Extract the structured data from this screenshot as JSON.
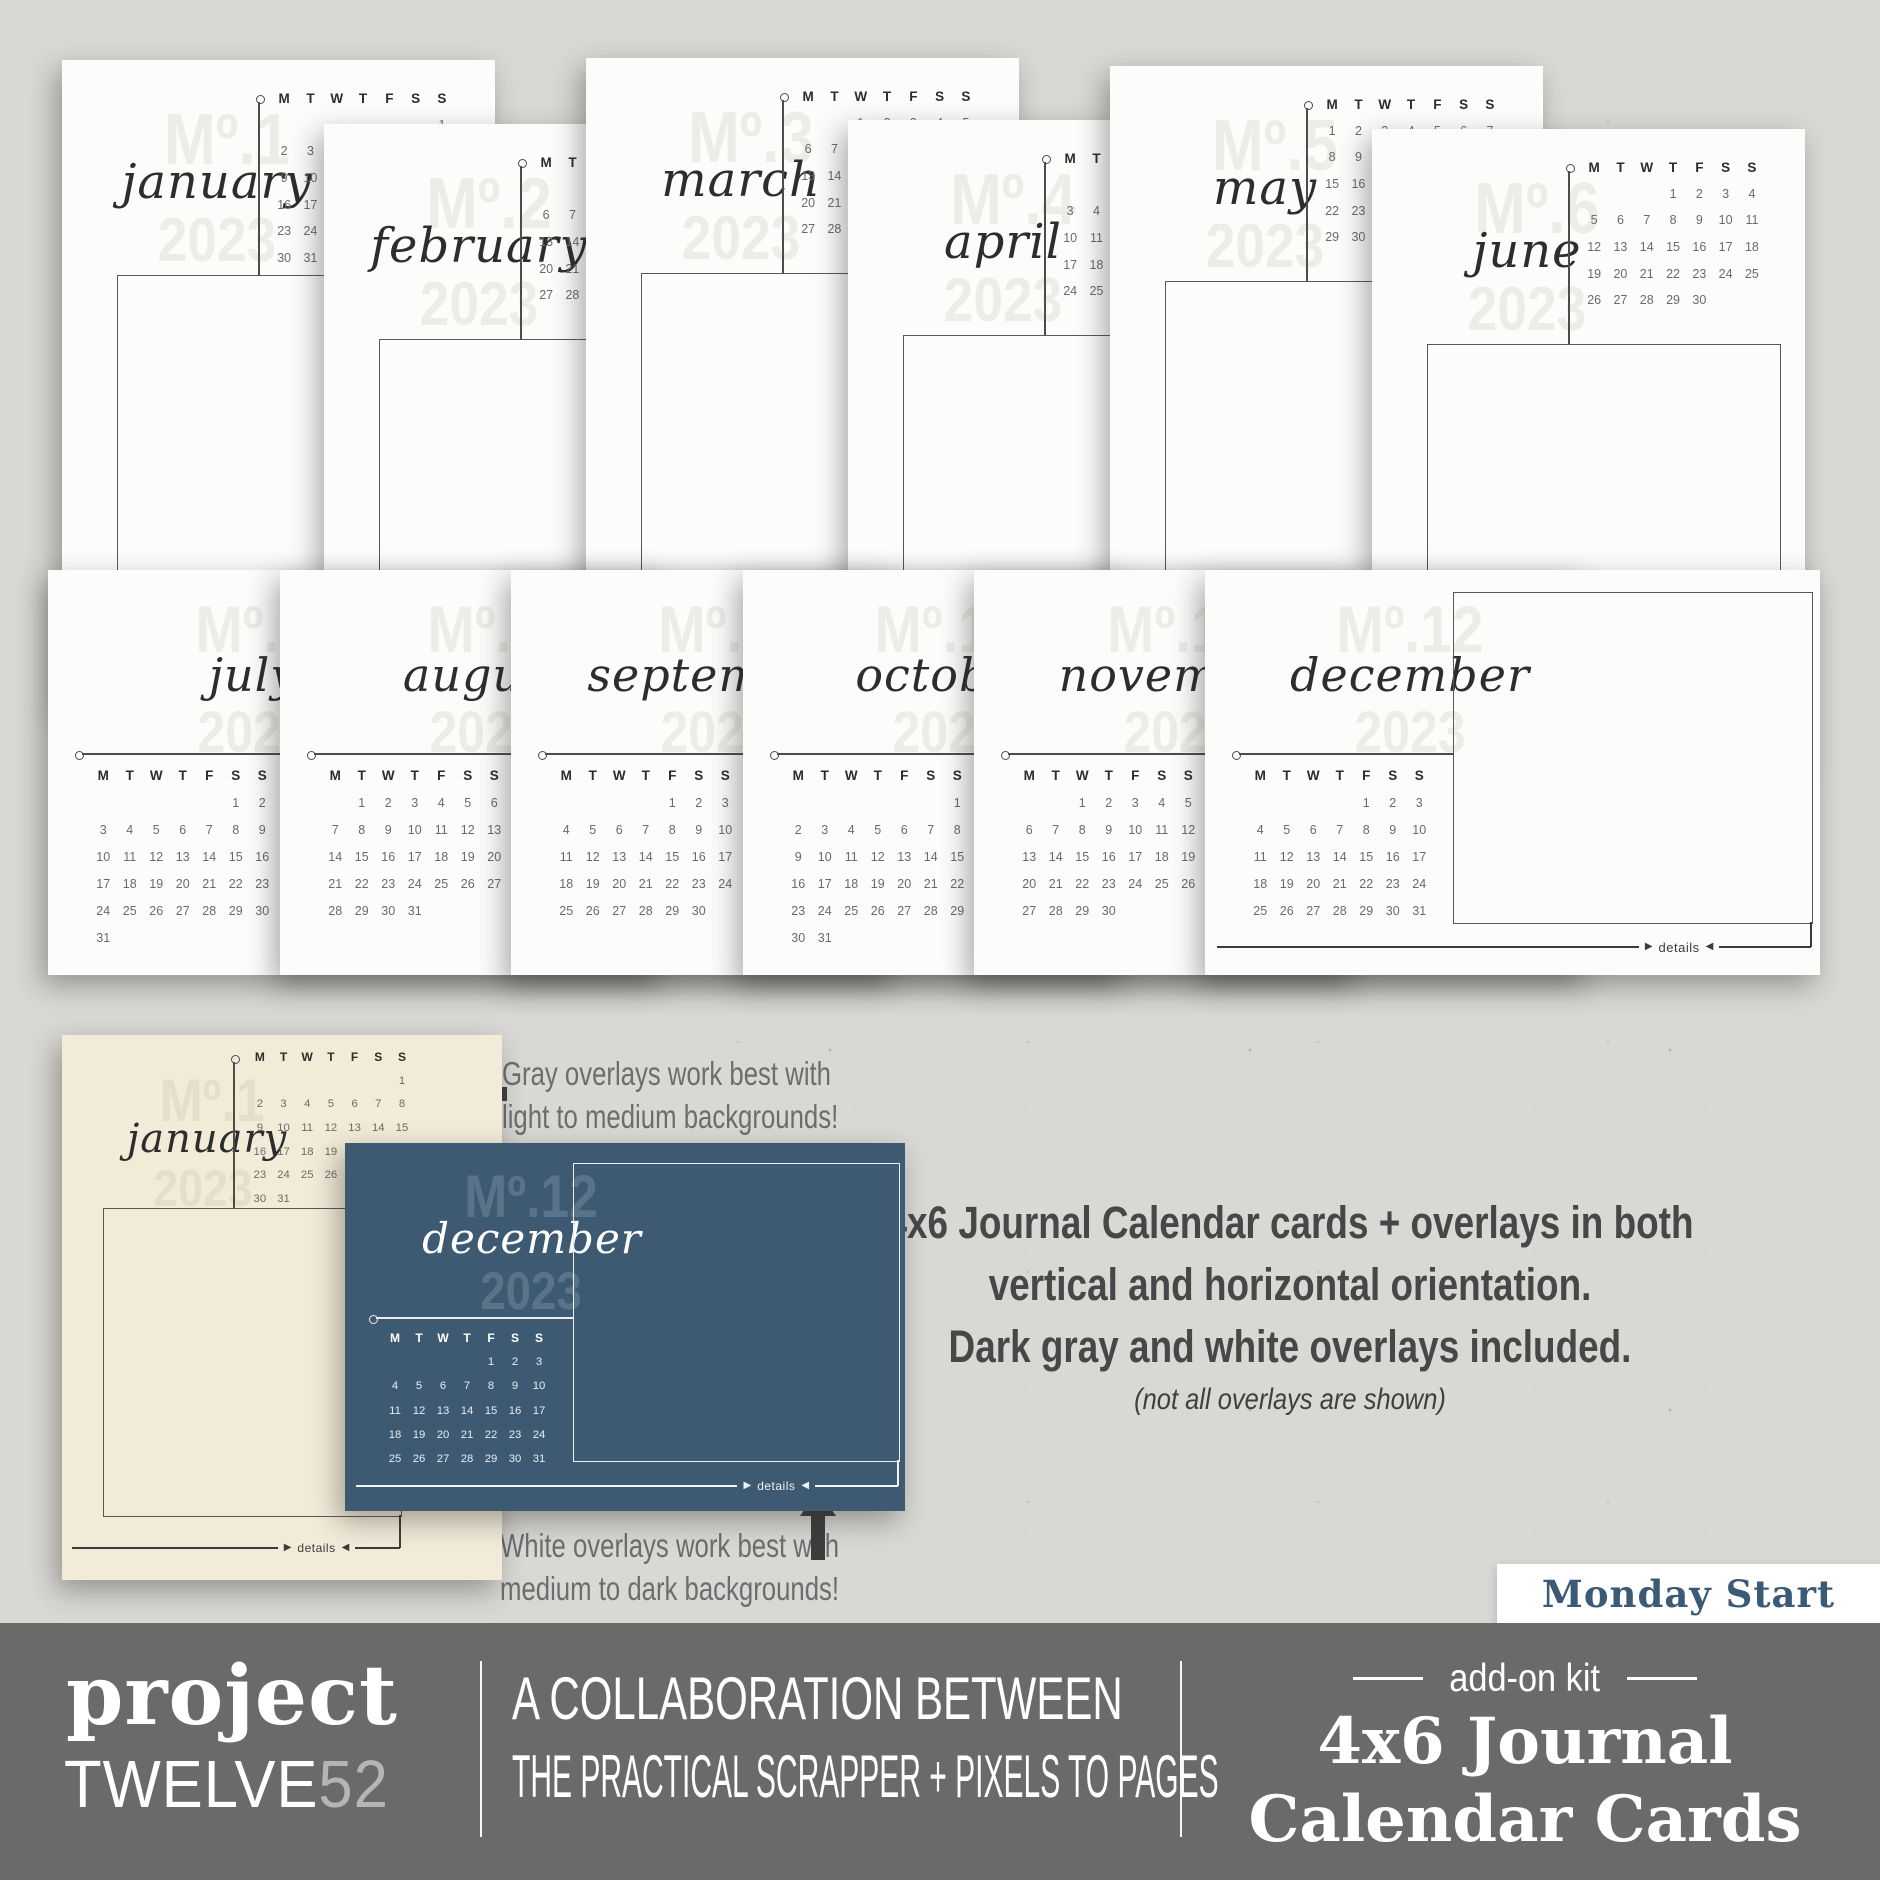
{
  "labels": {
    "details": "details"
  },
  "weekdays": [
    "M",
    "T",
    "W",
    "T",
    "F",
    "S",
    "S"
  ],
  "months": [
    {
      "wm": "Mº.1",
      "name": "january",
      "year": "2023",
      "rows": [
        [
          "",
          "",
          "",
          "",
          "",
          "",
          "1"
        ],
        [
          "2",
          "3",
          "4",
          "5",
          "6",
          "7",
          "8"
        ],
        [
          "9",
          "10",
          "11",
          "12",
          "13",
          "14",
          "15"
        ],
        [
          "16",
          "17",
          "18",
          "19",
          "20",
          "21",
          "22"
        ],
        [
          "23",
          "24",
          "25",
          "26",
          "27",
          "28",
          "29"
        ],
        [
          "30",
          "31",
          "",
          "",
          "",
          "",
          ""
        ]
      ]
    },
    {
      "wm": "Mº.2",
      "name": "february",
      "year": "2023",
      "rows": [
        [
          "",
          "",
          "1",
          "2",
          "3",
          "4",
          "5"
        ],
        [
          "6",
          "7",
          "8",
          "9",
          "10",
          "11",
          "12"
        ],
        [
          "13",
          "14",
          "15",
          "16",
          "17",
          "18",
          "19"
        ],
        [
          "20",
          "21",
          "22",
          "23",
          "24",
          "25",
          "26"
        ],
        [
          "27",
          "28",
          "",
          "",
          "",
          "",
          ""
        ]
      ]
    },
    {
      "wm": "Mº.3",
      "name": "march",
      "year": "2023",
      "rows": [
        [
          "",
          "",
          "1",
          "2",
          "3",
          "4",
          "5"
        ],
        [
          "6",
          "7",
          "8",
          "9",
          "10",
          "11",
          "12"
        ],
        [
          "13",
          "14",
          "15",
          "16",
          "17",
          "18",
          "19"
        ],
        [
          "20",
          "21",
          "22",
          "23",
          "24",
          "25",
          "26"
        ],
        [
          "27",
          "28",
          "29",
          "30",
          "31",
          "",
          ""
        ]
      ]
    },
    {
      "wm": "Mº.4",
      "name": "april",
      "year": "2023",
      "rows": [
        [
          "",
          "",
          "",
          "",
          "",
          "1",
          "2"
        ],
        [
          "3",
          "4",
          "5",
          "6",
          "7",
          "8",
          "9"
        ],
        [
          "10",
          "11",
          "12",
          "13",
          "14",
          "15",
          "16"
        ],
        [
          "17",
          "18",
          "19",
          "20",
          "21",
          "22",
          "23"
        ],
        [
          "24",
          "25",
          "26",
          "27",
          "28",
          "29",
          "30"
        ]
      ]
    },
    {
      "wm": "Mº.5",
      "name": "may",
      "year": "2023",
      "rows": [
        [
          "1",
          "2",
          "3",
          "4",
          "5",
          "6",
          "7"
        ],
        [
          "8",
          "9",
          "10",
          "11",
          "12",
          "13",
          "14"
        ],
        [
          "15",
          "16",
          "17",
          "18",
          "19",
          "20",
          "21"
        ],
        [
          "22",
          "23",
          "24",
          "25",
          "26",
          "27",
          "28"
        ],
        [
          "29",
          "30",
          "31",
          "",
          "",
          "",
          ""
        ]
      ]
    },
    {
      "wm": "Mº.6",
      "name": "june",
      "year": "2023",
      "rows": [
        [
          "",
          "",
          "",
          "1",
          "2",
          "3",
          "4"
        ],
        [
          "5",
          "6",
          "7",
          "8",
          "9",
          "10",
          "11"
        ],
        [
          "12",
          "13",
          "14",
          "15",
          "16",
          "17",
          "18"
        ],
        [
          "19",
          "20",
          "21",
          "22",
          "23",
          "24",
          "25"
        ],
        [
          "26",
          "27",
          "28",
          "29",
          "30",
          "",
          ""
        ]
      ]
    },
    {
      "wm": "Mº.7",
      "name": "july",
      "year": "2023",
      "rows": [
        [
          "",
          "",
          "",
          "",
          "",
          "1",
          "2"
        ],
        [
          "3",
          "4",
          "5",
          "6",
          "7",
          "8",
          "9"
        ],
        [
          "10",
          "11",
          "12",
          "13",
          "14",
          "15",
          "16"
        ],
        [
          "17",
          "18",
          "19",
          "20",
          "21",
          "22",
          "23"
        ],
        [
          "24",
          "25",
          "26",
          "27",
          "28",
          "29",
          "30"
        ],
        [
          "31",
          "",
          "",
          "",
          "",
          "",
          ""
        ]
      ]
    },
    {
      "wm": "Mº.8",
      "name": "august",
      "year": "2023",
      "rows": [
        [
          "",
          "1",
          "2",
          "3",
          "4",
          "5",
          "6"
        ],
        [
          "7",
          "8",
          "9",
          "10",
          "11",
          "12",
          "13"
        ],
        [
          "14",
          "15",
          "16",
          "17",
          "18",
          "19",
          "20"
        ],
        [
          "21",
          "22",
          "23",
          "24",
          "25",
          "26",
          "27"
        ],
        [
          "28",
          "29",
          "30",
          "31",
          "",
          "",
          ""
        ]
      ]
    },
    {
      "wm": "Mº.9",
      "name": "september",
      "year": "2023",
      "rows": [
        [
          "",
          "",
          "",
          "",
          "1",
          "2",
          "3"
        ],
        [
          "4",
          "5",
          "6",
          "7",
          "8",
          "9",
          "10"
        ],
        [
          "11",
          "12",
          "13",
          "14",
          "15",
          "16",
          "17"
        ],
        [
          "18",
          "19",
          "20",
          "21",
          "22",
          "23",
          "24"
        ],
        [
          "25",
          "26",
          "27",
          "28",
          "29",
          "30",
          ""
        ]
      ]
    },
    {
      "wm": "Mº.10",
      "name": "october",
      "year": "2023",
      "rows": [
        [
          "",
          "",
          "",
          "",
          "",
          "",
          "1"
        ],
        [
          "2",
          "3",
          "4",
          "5",
          "6",
          "7",
          "8"
        ],
        [
          "9",
          "10",
          "11",
          "12",
          "13",
          "14",
          "15"
        ],
        [
          "16",
          "17",
          "18",
          "19",
          "20",
          "21",
          "22"
        ],
        [
          "23",
          "24",
          "25",
          "26",
          "27",
          "28",
          "29"
        ],
        [
          "30",
          "31",
          "",
          "",
          "",
          "",
          ""
        ]
      ]
    },
    {
      "wm": "Mº.11",
      "name": "november",
      "year": "2023",
      "rows": [
        [
          "",
          "",
          "1",
          "2",
          "3",
          "4",
          "5"
        ],
        [
          "6",
          "7",
          "8",
          "9",
          "10",
          "11",
          "12"
        ],
        [
          "13",
          "14",
          "15",
          "16",
          "17",
          "18",
          "19"
        ],
        [
          "20",
          "21",
          "22",
          "23",
          "24",
          "25",
          "26"
        ],
        [
          "27",
          "28",
          "29",
          "30",
          "",
          "",
          ""
        ]
      ]
    },
    {
      "wm": "Mº.12",
      "name": "december",
      "year": "2023",
      "rows": [
        [
          "",
          "",
          "",
          "",
          "1",
          "2",
          "3"
        ],
        [
          "4",
          "5",
          "6",
          "7",
          "8",
          "9",
          "10"
        ],
        [
          "11",
          "12",
          "13",
          "14",
          "15",
          "16",
          "17"
        ],
        [
          "18",
          "19",
          "20",
          "21",
          "22",
          "23",
          "24"
        ],
        [
          "25",
          "26",
          "27",
          "28",
          "29",
          "30",
          "31"
        ]
      ]
    }
  ],
  "annotations": {
    "gray_line1": "Gray overlays work best with",
    "gray_line2": "light to medium backgrounds!",
    "white_line1": "White overlays work best with",
    "white_line2": "medium to dark backgrounds!"
  },
  "description": {
    "line1": "4x6 Journal Calendar cards + overlays in both",
    "line2": "vertical and horizontal orientation.",
    "line3": "Dark gray and white overlays included.",
    "note": "(not all overlays are shown)"
  },
  "badge": {
    "label": "Monday Start"
  },
  "footer": {
    "brand_top": "project",
    "brand_word": "TWELVE",
    "brand_num": "52",
    "collab_line1": "A COLLABORATION BETWEEN",
    "collab_line2": "THE PRACTICAL SCRAPPER + PIXELS TO PAGES",
    "kit_label": "add-on kit",
    "title_line1": "4x6 Journal",
    "title_line2": "Calendar Cards"
  },
  "colors": {
    "background": "#d9d8d4",
    "card_white": "#fcfcfb",
    "card_cream": "#f1ebd8",
    "card_blue": "#3e5a73",
    "footer_gray": "#6a6a69",
    "badge_text_blue": "#3a5a76",
    "ink": "#2d2d2d"
  }
}
